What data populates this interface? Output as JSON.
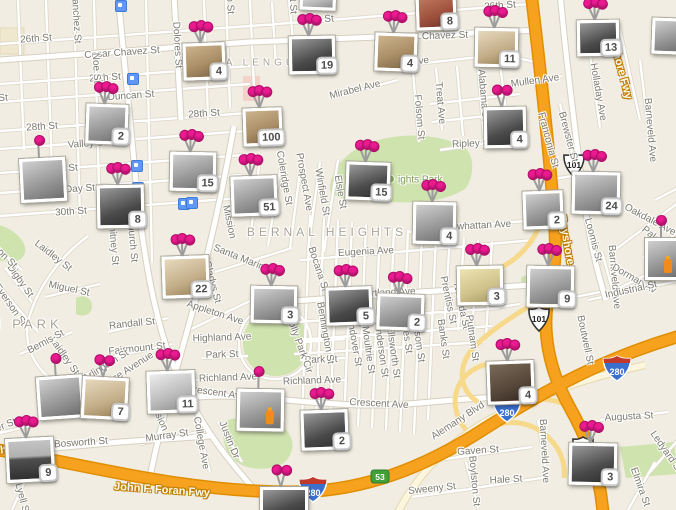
{
  "map": {
    "colors": {
      "background": "#f1ede2",
      "freeway": "#f6a21f",
      "freeway_casing": "#e08e00",
      "ramp": "#f7d98c",
      "park": "#cfe3ae",
      "pin": "#eb1a90",
      "badge_border": "#c6c6c6",
      "badge_text": "#4c4c4c",
      "transit_blue": "#5e97f5",
      "road_white": "#ffffff",
      "label_gray": "#7d7a70"
    },
    "area_labels": [
      {
        "t": "BERNAL HEIGHTS",
        "x": 327,
        "y": 232,
        "s": 12
      },
      {
        "t": "LA LENGUA",
        "x": 262,
        "y": 63,
        "s": 10
      },
      {
        "t": "GLEN PARK",
        "x": 8,
        "y": 324,
        "s": 13
      }
    ],
    "park_label": {
      "t": "ights Park",
      "x": 386,
      "y": 180
    },
    "freeway_labels": [
      {
        "t": "Bayshore Fwy",
        "x": 619,
        "y": 63,
        "r": 75
      },
      {
        "t": "Bayshore",
        "x": 566,
        "y": 240,
        "r": 80
      },
      {
        "t": "John F. Foran Fwy",
        "x": 162,
        "y": 490,
        "r": 4
      },
      {
        "t": "Southern Fwy",
        "x": 12,
        "y": 449,
        "r": -8
      }
    ],
    "street_labels": [
      {
        "t": "26th St",
        "x": 36,
        "y": 39,
        "r": -4
      },
      {
        "t": "26th St",
        "x": 318,
        "y": 20,
        "r": -4
      },
      {
        "t": "26th St",
        "x": 500,
        "y": 6,
        "r": -4
      },
      {
        "t": "Cesar Chavez St",
        "x": 122,
        "y": 53,
        "r": -4
      },
      {
        "t": "Chavez St",
        "x": 445,
        "y": 36,
        "r": -2
      },
      {
        "t": "27th St",
        "x": 105,
        "y": 78,
        "r": -4
      },
      {
        "t": "27th St",
        "x": -8,
        "y": 99,
        "r": -4
      },
      {
        "t": "Duncan St",
        "x": 131,
        "y": 96,
        "r": -4
      },
      {
        "t": "28th St",
        "x": 42,
        "y": 127,
        "r": -4
      },
      {
        "t": "28th St",
        "x": 204,
        "y": 114,
        "r": -4
      },
      {
        "t": "Valley St",
        "x": 87,
        "y": 144,
        "r": -4
      },
      {
        "t": "29th St",
        "x": 62,
        "y": 169,
        "r": -4
      },
      {
        "t": "Day St",
        "x": 80,
        "y": 189,
        "r": -4
      },
      {
        "t": "30th St",
        "x": 71,
        "y": 212,
        "r": -4
      },
      {
        "t": "Randall St",
        "x": 132,
        "y": 324,
        "r": -6
      },
      {
        "t": "Fairmount St",
        "x": 137,
        "y": 349,
        "r": -6
      },
      {
        "t": "Miguel St",
        "x": 69,
        "y": 289,
        "r": 12
      },
      {
        "t": "Laidley St",
        "x": 53,
        "y": 256,
        "r": 38
      },
      {
        "t": "Laidley St",
        "x": 64,
        "y": 356,
        "r": 55
      },
      {
        "t": "Digby St",
        "x": 20,
        "y": 281,
        "r": 55
      },
      {
        "t": "Everson St",
        "x": 10,
        "y": 305,
        "r": 55
      },
      {
        "t": "Addison St",
        "x": -2,
        "y": 250,
        "r": 45
      },
      {
        "t": "Bemis St",
        "x": 46,
        "y": 342,
        "r": -28
      },
      {
        "t": "Wilder St",
        "x": -3,
        "y": 429,
        "r": -22
      },
      {
        "t": "Bosworth St",
        "x": 81,
        "y": 443,
        "r": -4
      },
      {
        "t": "Murray St",
        "x": 167,
        "y": 436,
        "r": -8
      },
      {
        "t": "College Ave",
        "x": 201,
        "y": 443,
        "r": 80
      },
      {
        "t": "Justin Dr",
        "x": 229,
        "y": 440,
        "r": 68
      },
      {
        "t": "Lyell St",
        "x": 22,
        "y": 499,
        "r": 75
      },
      {
        "t": "Arlington St",
        "x": 106,
        "y": 366,
        "r": -32
      },
      {
        "t": "se Avenue",
        "x": 133,
        "y": 367,
        "r": -33
      },
      {
        "t": "Mission",
        "x": 229,
        "y": 222,
        "r": 78
      },
      {
        "t": "Mission",
        "x": 158,
        "y": 415,
        "r": 65
      },
      {
        "t": "Whitney St",
        "x": 113,
        "y": 241,
        "r": 85
      },
      {
        "t": "Church St",
        "x": 132,
        "y": 240,
        "r": 85
      },
      {
        "t": "Sanchez St",
        "x": 76,
        "y": 18,
        "r": 87
      },
      {
        "t": "Noe St",
        "x": 96,
        "y": 68,
        "r": 87
      },
      {
        "t": "Dolores St",
        "x": 177,
        "y": 45,
        "r": 87
      },
      {
        "t": "Guerrero St",
        "x": 229,
        "y": -12,
        "r": 87
      },
      {
        "t": "Bartlett St",
        "x": 292,
        "y": -8,
        "r": 87
      },
      {
        "t": "Coleridge St",
        "x": 284,
        "y": 178,
        "r": 80
      },
      {
        "t": "Prospect Ave",
        "x": 304,
        "y": 182,
        "r": 80
      },
      {
        "t": "Winfield St",
        "x": 322,
        "y": 192,
        "r": 80
      },
      {
        "t": "Elsie St",
        "x": 340,
        "y": 192,
        "r": 80
      },
      {
        "t": "Santa Marina St",
        "x": 247,
        "y": 261,
        "r": 22
      },
      {
        "t": "Gladys St",
        "x": 212,
        "y": 282,
        "r": 75
      },
      {
        "t": "Bocana St",
        "x": 318,
        "y": 269,
        "r": 72
      },
      {
        "t": "Eugenia Ave",
        "x": 366,
        "y": 252,
        "r": -3
      },
      {
        "t": "Cortland Ave",
        "x": 387,
        "y": 293,
        "r": -3
      },
      {
        "t": "Powhattan Ave",
        "x": 478,
        "y": 226,
        "r": -3
      },
      {
        "t": "Richland Ave",
        "x": 228,
        "y": 378,
        "r": -2
      },
      {
        "t": "Richland Ave",
        "x": 312,
        "y": 381,
        "r": -2
      },
      {
        "t": "Park St",
        "x": 222,
        "y": 355,
        "r": -2
      },
      {
        "t": "Park St",
        "x": 321,
        "y": 360,
        "r": -2
      },
      {
        "t": "Highland Ave",
        "x": 222,
        "y": 338,
        "r": -2
      },
      {
        "t": "Appleton Ave",
        "x": 215,
        "y": 313,
        "r": 18
      },
      {
        "t": "Crescent Ave",
        "x": 216,
        "y": 393,
        "r": 8
      },
      {
        "t": "Crescent Ave",
        "x": 379,
        "y": 404,
        "r": 3
      },
      {
        "t": "Holly Park Cir",
        "x": 299,
        "y": 344,
        "r": 70
      },
      {
        "t": "Bennington St",
        "x": 325,
        "y": 333,
        "r": 80
      },
      {
        "t": "Andover St",
        "x": 354,
        "y": 342,
        "r": 80
      },
      {
        "t": "Moultrie St",
        "x": 368,
        "y": 350,
        "r": 82
      },
      {
        "t": "Anderson St",
        "x": 381,
        "y": 350,
        "r": 82
      },
      {
        "t": "Ellsworth St",
        "x": 393,
        "y": 352,
        "r": 82
      },
      {
        "t": "Gates St",
        "x": 406,
        "y": 334,
        "r": 82
      },
      {
        "t": "Folsom St",
        "x": 418,
        "y": 340,
        "r": 82
      },
      {
        "t": "Banks St",
        "x": 443,
        "y": 339,
        "r": 82
      },
      {
        "t": "Nevada St",
        "x": 461,
        "y": 306,
        "r": 78
      },
      {
        "t": "Putnam St",
        "x": 472,
        "y": 338,
        "r": 82
      },
      {
        "t": "Prentiss St",
        "x": 448,
        "y": 300,
        "r": 78
      },
      {
        "t": "Mirabel Ave",
        "x": 355,
        "y": 90,
        "r": -14
      },
      {
        "t": "Precita Ave",
        "x": 404,
        "y": 63,
        "r": -6
      },
      {
        "t": "Folsom St",
        "x": 419,
        "y": 117,
        "r": 85
      },
      {
        "t": "Treat Ave",
        "x": 440,
        "y": 103,
        "r": 85
      },
      {
        "t": "Alabama St",
        "x": 483,
        "y": 95,
        "r": 85
      },
      {
        "t": "Mullen Ave",
        "x": 535,
        "y": 81,
        "r": -8
      },
      {
        "t": "Ripley St",
        "x": 472,
        "y": 144,
        "r": -2
      },
      {
        "t": "Franconia St",
        "x": 548,
        "y": 140,
        "r": 75
      },
      {
        "t": "Brewster St",
        "x": 568,
        "y": 137,
        "r": 75
      },
      {
        "t": "Holladay Ave",
        "x": 598,
        "y": 92,
        "r": 80
      },
      {
        "t": "Barneveld Ave",
        "x": 650,
        "y": 130,
        "r": 85
      },
      {
        "t": "Barneveld Ave",
        "x": 614,
        "y": 277,
        "r": 85
      },
      {
        "t": "Barneveld Ave",
        "x": 544,
        "y": 451,
        "r": 87
      },
      {
        "t": "Loomis St",
        "x": 593,
        "y": 240,
        "r": 75
      },
      {
        "t": "Oakdale Ave",
        "x": 650,
        "y": 220,
        "r": 28
      },
      {
        "t": "Palou Av",
        "x": 658,
        "y": 241,
        "r": 40
      },
      {
        "t": "Dorman Av",
        "x": 634,
        "y": 279,
        "r": 30
      },
      {
        "t": "Industrial St",
        "x": 631,
        "y": 290,
        "r": -12
      },
      {
        "t": "Boutwell St",
        "x": 585,
        "y": 340,
        "r": 78
      },
      {
        "t": "Augusta St",
        "x": 629,
        "y": 417,
        "r": -3
      },
      {
        "t": "Gaven St",
        "x": 478,
        "y": 451,
        "r": -4
      },
      {
        "t": "Hale St",
        "x": 506,
        "y": 480,
        "r": -3
      },
      {
        "t": "Sweeny St",
        "x": 432,
        "y": 489,
        "r": -6
      },
      {
        "t": "Boylston St",
        "x": 474,
        "y": 481,
        "r": 85
      },
      {
        "t": "Elmira St",
        "x": 640,
        "y": 487,
        "r": 70
      },
      {
        "t": "Ledyard St",
        "x": 666,
        "y": 452,
        "r": 55
      },
      {
        "t": "Alemany Blvd",
        "x": 458,
        "y": 421,
        "r": -33
      }
    ],
    "shields": [
      {
        "type": "us",
        "t": "101",
        "x": 526,
        "y": 306
      },
      {
        "type": "us",
        "t": "101",
        "x": 561,
        "y": 152
      },
      {
        "type": "us",
        "t": "101",
        "x": 570,
        "y": 436
      },
      {
        "type": "i",
        "t": "280",
        "x": 298,
        "y": 476
      },
      {
        "type": "i",
        "t": "280",
        "x": 492,
        "y": 396
      },
      {
        "type": "i",
        "t": "280",
        "x": 602,
        "y": 355
      },
      {
        "type": "g",
        "t": "53",
        "x": 370,
        "y": 469
      }
    ],
    "transit_stops": [
      {
        "x": 115,
        "y": 0
      },
      {
        "x": 127,
        "y": 73
      },
      {
        "x": 131,
        "y": 160
      },
      {
        "x": 132,
        "y": 182
      },
      {
        "x": 178,
        "y": 198
      },
      {
        "x": 186,
        "y": 197
      }
    ],
    "markers": [
      {
        "x": 300,
        "y": -12,
        "w": 30,
        "h": 16,
        "b": null,
        "tone": "grayLight",
        "p": 0,
        "tilt": 2
      },
      {
        "x": 416,
        "y": -6,
        "w": 34,
        "h": 30,
        "b": "8",
        "tone": "color",
        "p": 2,
        "tilt": -2
      },
      {
        "x": 183,
        "y": 43,
        "w": 36,
        "h": 31,
        "b": "4",
        "tone": "sepia",
        "p": 3,
        "tilt": -2
      },
      {
        "x": 375,
        "y": 33,
        "w": 36,
        "h": 32,
        "b": "4",
        "tone": "sepia",
        "p": 3,
        "tilt": 2
      },
      {
        "x": 475,
        "y": 28,
        "w": 37,
        "h": 33,
        "b": "11",
        "tone": "sepiaLight",
        "p": 3,
        "tilt": 1
      },
      {
        "x": 289,
        "y": 36,
        "w": 40,
        "h": 32,
        "b": "19",
        "tone": "grayDark",
        "p": 3,
        "tilt": -1
      },
      {
        "x": 577,
        "y": 20,
        "w": 36,
        "h": 30,
        "b": "13",
        "tone": "grayDark",
        "p": 3,
        "tilt": -1
      },
      {
        "x": 652,
        "y": 18,
        "w": 26,
        "h": 30,
        "b": null,
        "tone": "gray",
        "p": 0,
        "tilt": 2
      },
      {
        "x": 86,
        "y": 104,
        "w": 36,
        "h": 34,
        "b": "2",
        "tone": "gray",
        "p": 3,
        "tilt": 2
      },
      {
        "x": 484,
        "y": 107,
        "w": 36,
        "h": 35,
        "b": "4",
        "tone": "grayDark",
        "p": 2,
        "tilt": -1
      },
      {
        "x": 243,
        "y": 108,
        "w": 33,
        "h": 32,
        "b": "100",
        "tone": "sepia",
        "p": 3,
        "tilt": -2
      },
      {
        "x": 170,
        "y": 152,
        "w": 40,
        "h": 33,
        "b": "15",
        "tone": "gray",
        "p": 3,
        "tilt": 1
      },
      {
        "x": 346,
        "y": 162,
        "w": 38,
        "h": 32,
        "b": "15",
        "tone": "grayDark",
        "p": 3,
        "tilt": 2
      },
      {
        "x": 572,
        "y": 172,
        "w": 42,
        "h": 36,
        "b": "24",
        "tone": "gray",
        "p": 3,
        "tilt": 1
      },
      {
        "x": 231,
        "y": 176,
        "w": 40,
        "h": 34,
        "b": "51",
        "tone": "gray",
        "p": 3,
        "tilt": -2
      },
      {
        "x": 523,
        "y": 191,
        "w": 34,
        "h": 32,
        "b": "2",
        "tone": "gray",
        "p": 3,
        "tilt": -2
      },
      {
        "x": 413,
        "y": 202,
        "w": 37,
        "h": 36,
        "b": "4",
        "tone": "gray",
        "p": 3,
        "tilt": 1
      },
      {
        "x": 20,
        "y": 158,
        "w": 40,
        "h": 38,
        "b": null,
        "tone": "gray",
        "p": 1,
        "tilt": -3
      },
      {
        "x": 97,
        "y": 185,
        "w": 41,
        "h": 37,
        "b": "8",
        "tone": "grayDark",
        "p": 3,
        "tilt": -1
      },
      {
        "x": 645,
        "y": 238,
        "w": 31,
        "h": 36,
        "b": null,
        "tone": "gray",
        "p": 1,
        "tilt": 0,
        "acc": "orange"
      },
      {
        "x": 162,
        "y": 256,
        "w": 41,
        "h": 36,
        "b": "22",
        "tone": "sepiaLight",
        "p": 3,
        "tilt": -2
      },
      {
        "x": 457,
        "y": 266,
        "w": 40,
        "h": 33,
        "b": "3",
        "tone": "yellow",
        "p": 3,
        "tilt": -1
      },
      {
        "x": 527,
        "y": 266,
        "w": 41,
        "h": 35,
        "b": "9",
        "tone": "gray",
        "p": 3,
        "tilt": 1
      },
      {
        "x": 251,
        "y": 286,
        "w": 40,
        "h": 31,
        "b": "3",
        "tone": "gray",
        "p": 3,
        "tilt": 1
      },
      {
        "x": 326,
        "y": 287,
        "w": 40,
        "h": 32,
        "b": "5",
        "tone": "grayDark",
        "p": 3,
        "tilt": -2
      },
      {
        "x": 377,
        "y": 294,
        "w": 41,
        "h": 30,
        "b": "2",
        "tone": "gray",
        "p": 3,
        "tilt": 2
      },
      {
        "x": 37,
        "y": 376,
        "w": 40,
        "h": 37,
        "b": null,
        "tone": "gray",
        "p": 1,
        "tilt": -4
      },
      {
        "x": 82,
        "y": 377,
        "w": 40,
        "h": 36,
        "b": "7",
        "tone": "sepiaLight",
        "p": 2,
        "tilt": 3
      },
      {
        "x": 147,
        "y": 371,
        "w": 42,
        "h": 36,
        "b": "11",
        "tone": "grayLight",
        "p": 3,
        "tilt": -2
      },
      {
        "x": 487,
        "y": 361,
        "w": 41,
        "h": 37,
        "b": "4",
        "tone": "darkBrown",
        "p": 3,
        "tilt": -2
      },
      {
        "x": 6,
        "y": 438,
        "w": 42,
        "h": 38,
        "b": "9",
        "tone": "darkSky",
        "p": 3,
        "tilt": -3
      },
      {
        "x": 237,
        "y": 389,
        "w": 41,
        "h": 36,
        "b": null,
        "tone": "gray",
        "p": 1,
        "tilt": 1,
        "acc": "orange"
      },
      {
        "x": 301,
        "y": 410,
        "w": 41,
        "h": 34,
        "b": "2",
        "tone": "grayDark",
        "p": 3,
        "tilt": -2
      },
      {
        "x": 569,
        "y": 443,
        "w": 42,
        "h": 36,
        "b": "3",
        "tone": "grayDark",
        "p": 3,
        "tilt": 1
      },
      {
        "x": 260,
        "y": 487,
        "w": 42,
        "h": 28,
        "b": "",
        "tone": "grayDark",
        "p": 2,
        "tilt": 0
      }
    ]
  }
}
